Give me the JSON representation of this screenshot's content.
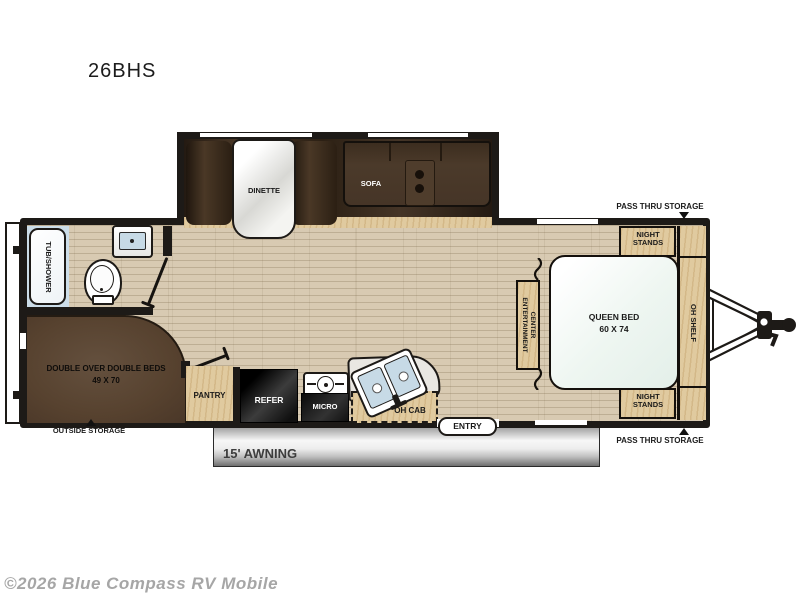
{
  "page": {
    "title": "26BHS",
    "copyright": "©2026 Blue Compass RV Mobile"
  },
  "colors": {
    "wall": "#1d1a17",
    "floor_wood": "#d8cab2",
    "cabinet_wood": "#e0ca9f",
    "slide_interior": "#3a2c1e",
    "bunk_brown": "#5a4535",
    "fixture_blue": "#c7dae6",
    "bed_fill": "#eef6f1",
    "awning_gray": "#8f8f8f",
    "copyright_gray": "#a6a6a6"
  },
  "floorplan": {
    "slideout": {
      "dinette_label": "DINETTE",
      "sofa_label": "SOFA"
    },
    "bathroom": {
      "tub_label": "TUB/SHOWER"
    },
    "bunk_room": {
      "name": "DOUBLE OVER DOUBLE BEDS",
      "size": "49 X 70"
    },
    "kitchen": {
      "pantry_label": "PANTRY",
      "refrigerator_label": "REFER",
      "microwave_label": "MICRO",
      "overhead_cabinet_label": "OH CAB"
    },
    "entry_label": "ENTRY",
    "awning_label": "15' AWNING",
    "bedroom": {
      "bed_label": "QUEEN BED",
      "bed_size": "60 X 74",
      "nightstand_front_label": "NIGHT STANDS",
      "nightstand_rear_label": "NIGHT STANDS",
      "oh_shelf_label": "OH SHELF",
      "entertainment_label": "CENTER ENTERTAINMENT"
    },
    "storage": {
      "outside_label": "OUTSIDE STORAGE",
      "pass_thru_front_label": "PASS THRU STORAGE",
      "pass_thru_rear_label": "PASS THRU STORAGE"
    }
  }
}
